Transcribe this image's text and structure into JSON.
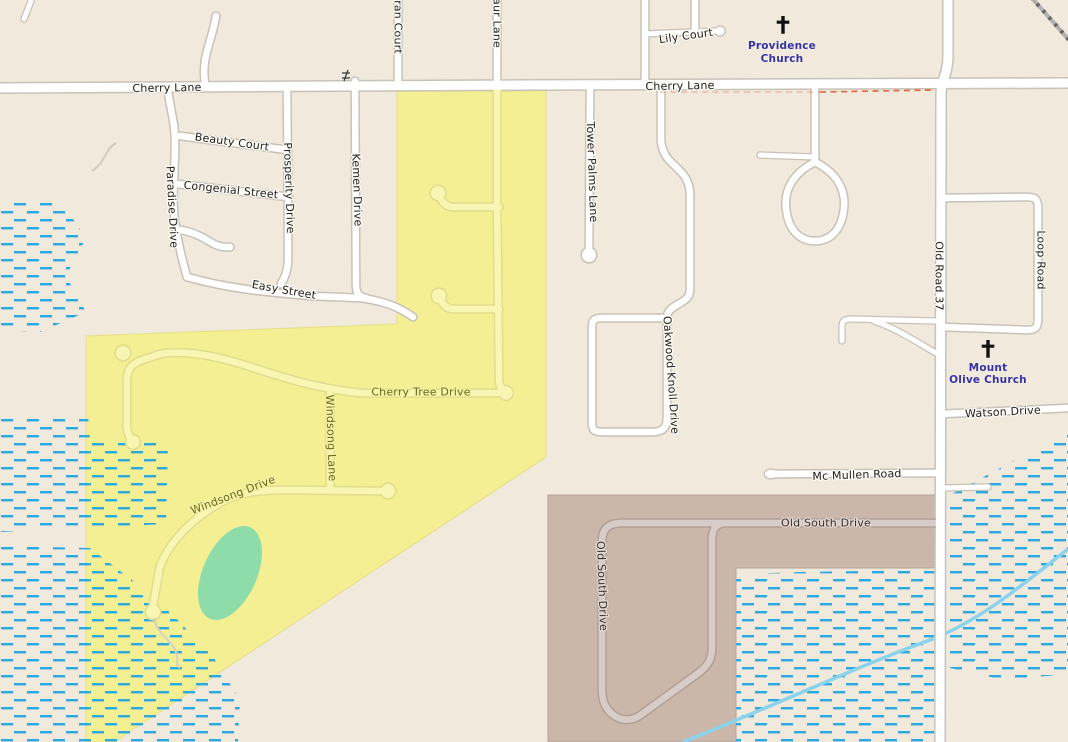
{
  "map": {
    "colors": {
      "land": "#f0e9dc",
      "road_fill": "#ffffff",
      "road_casing": "#c8c2b8",
      "yellow_area": "#f3ef92",
      "yellow_road": "#f9f6b4",
      "brown_area": "#cbb6aa",
      "brown_road": "#d7ccc7",
      "green_area": "#8fdcab",
      "wetland_dash": "#29a8e1",
      "stream": "#8bd3ec",
      "railway": "#8f8f8f",
      "boundary_dash": "#e0502a",
      "church_label": "#3434a6",
      "yellow_road_label": "#69691a"
    },
    "streets": {
      "cherry_lane": "Cherry Lane",
      "lily_court": "Lily Court",
      "ran_court": "ran Court",
      "aur_lane": "aur Lane",
      "beauty_court": "Beauty Court",
      "congenial_street": "Congenial Street",
      "paradise_drive": "Paradise Drive",
      "prosperity_drive": "Prosperity Drive",
      "kemen_drive": "Kemen Drive",
      "easy_street": "Easy Street",
      "tower_palms_lane": "Tower Palms Lane",
      "oakwood_knoll_drive": "Oakwood Knoll Drive",
      "old_road_37": "Old Road 37",
      "loop_road": "Loop Road",
      "watson_drive": "Watson Drive",
      "mc_mullen_road": "Mc Mullen Road",
      "old_south_drive": "Old South Drive",
      "cherry_tree_drive": "Cherry Tree Drive",
      "windsong_lane": "Windsong Lane",
      "windsong_drive": "Windsong Drive"
    },
    "places": {
      "providence_church_line1": "Providence",
      "providence_church_line2": "Church",
      "mount_olive_church_line1": "Mount",
      "mount_olive_church_line2": "Olive Church"
    }
  }
}
